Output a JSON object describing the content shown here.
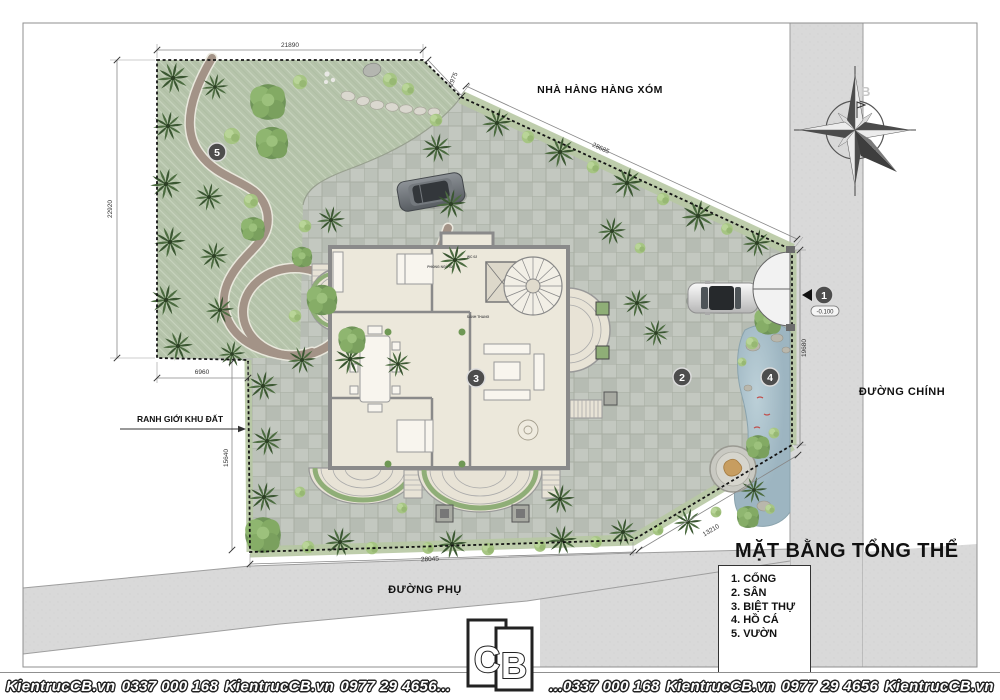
{
  "drawing_title": "MẶT BẰNG TỔNG THỂ",
  "legend": {
    "items": [
      "1. CỔNG",
      "2. SÂN",
      "3. BIỆT THỰ",
      "4. HỒ CÁ",
      "5. VƯỜN"
    ]
  },
  "site_labels": {
    "neighbor": "NHÀ HÀNG HÀNG XÓM",
    "main_road": "ĐƯỜNG CHÍNH",
    "side_road": "ĐƯỜNG PHỤ",
    "boundary": "RANH GIỚI KHU ĐẤT",
    "north": "B"
  },
  "dimensions": {
    "top": "21890",
    "top_corner": "2975",
    "northeast": "28685",
    "east": "19680",
    "southeast": "13210",
    "south": "28045",
    "west_lower": "15640",
    "west_step": "6960",
    "west": "22920",
    "gate_level": "-0.100"
  },
  "badges": {
    "gate": "1",
    "yard": "2",
    "villa": "3",
    "fish_pond": "4",
    "garden": "5"
  },
  "house_labels": {
    "bedroom": "PHÒNG NGỦ 02",
    "wc": "WC 02",
    "stair_hall": "SẢNH THANG"
  },
  "footer": {
    "items": [
      "KientrucCB.vn",
      "0337 000 168",
      "KientrucCB.vn",
      "0977 29 4656...",
      "...0337 000 168",
      "KientrucCB.vn",
      "0977 29 4656",
      "KientrucCB.vn"
    ],
    "logo_letters": {
      "c": "C",
      "b": "B"
    }
  },
  "colors": {
    "paving": "#c3c8c0",
    "garden_green": "#b6c4ab",
    "road_gray": "#d9d9d9",
    "pond_blue": "#a9c0cb",
    "house_floor": "#ece8db",
    "wall_gray": "#8a8a8a",
    "palm_green": "#3a5631",
    "tree_green": "#6f9458",
    "path_brown": "#a39387",
    "badge_gray": "#4d4d4d"
  }
}
